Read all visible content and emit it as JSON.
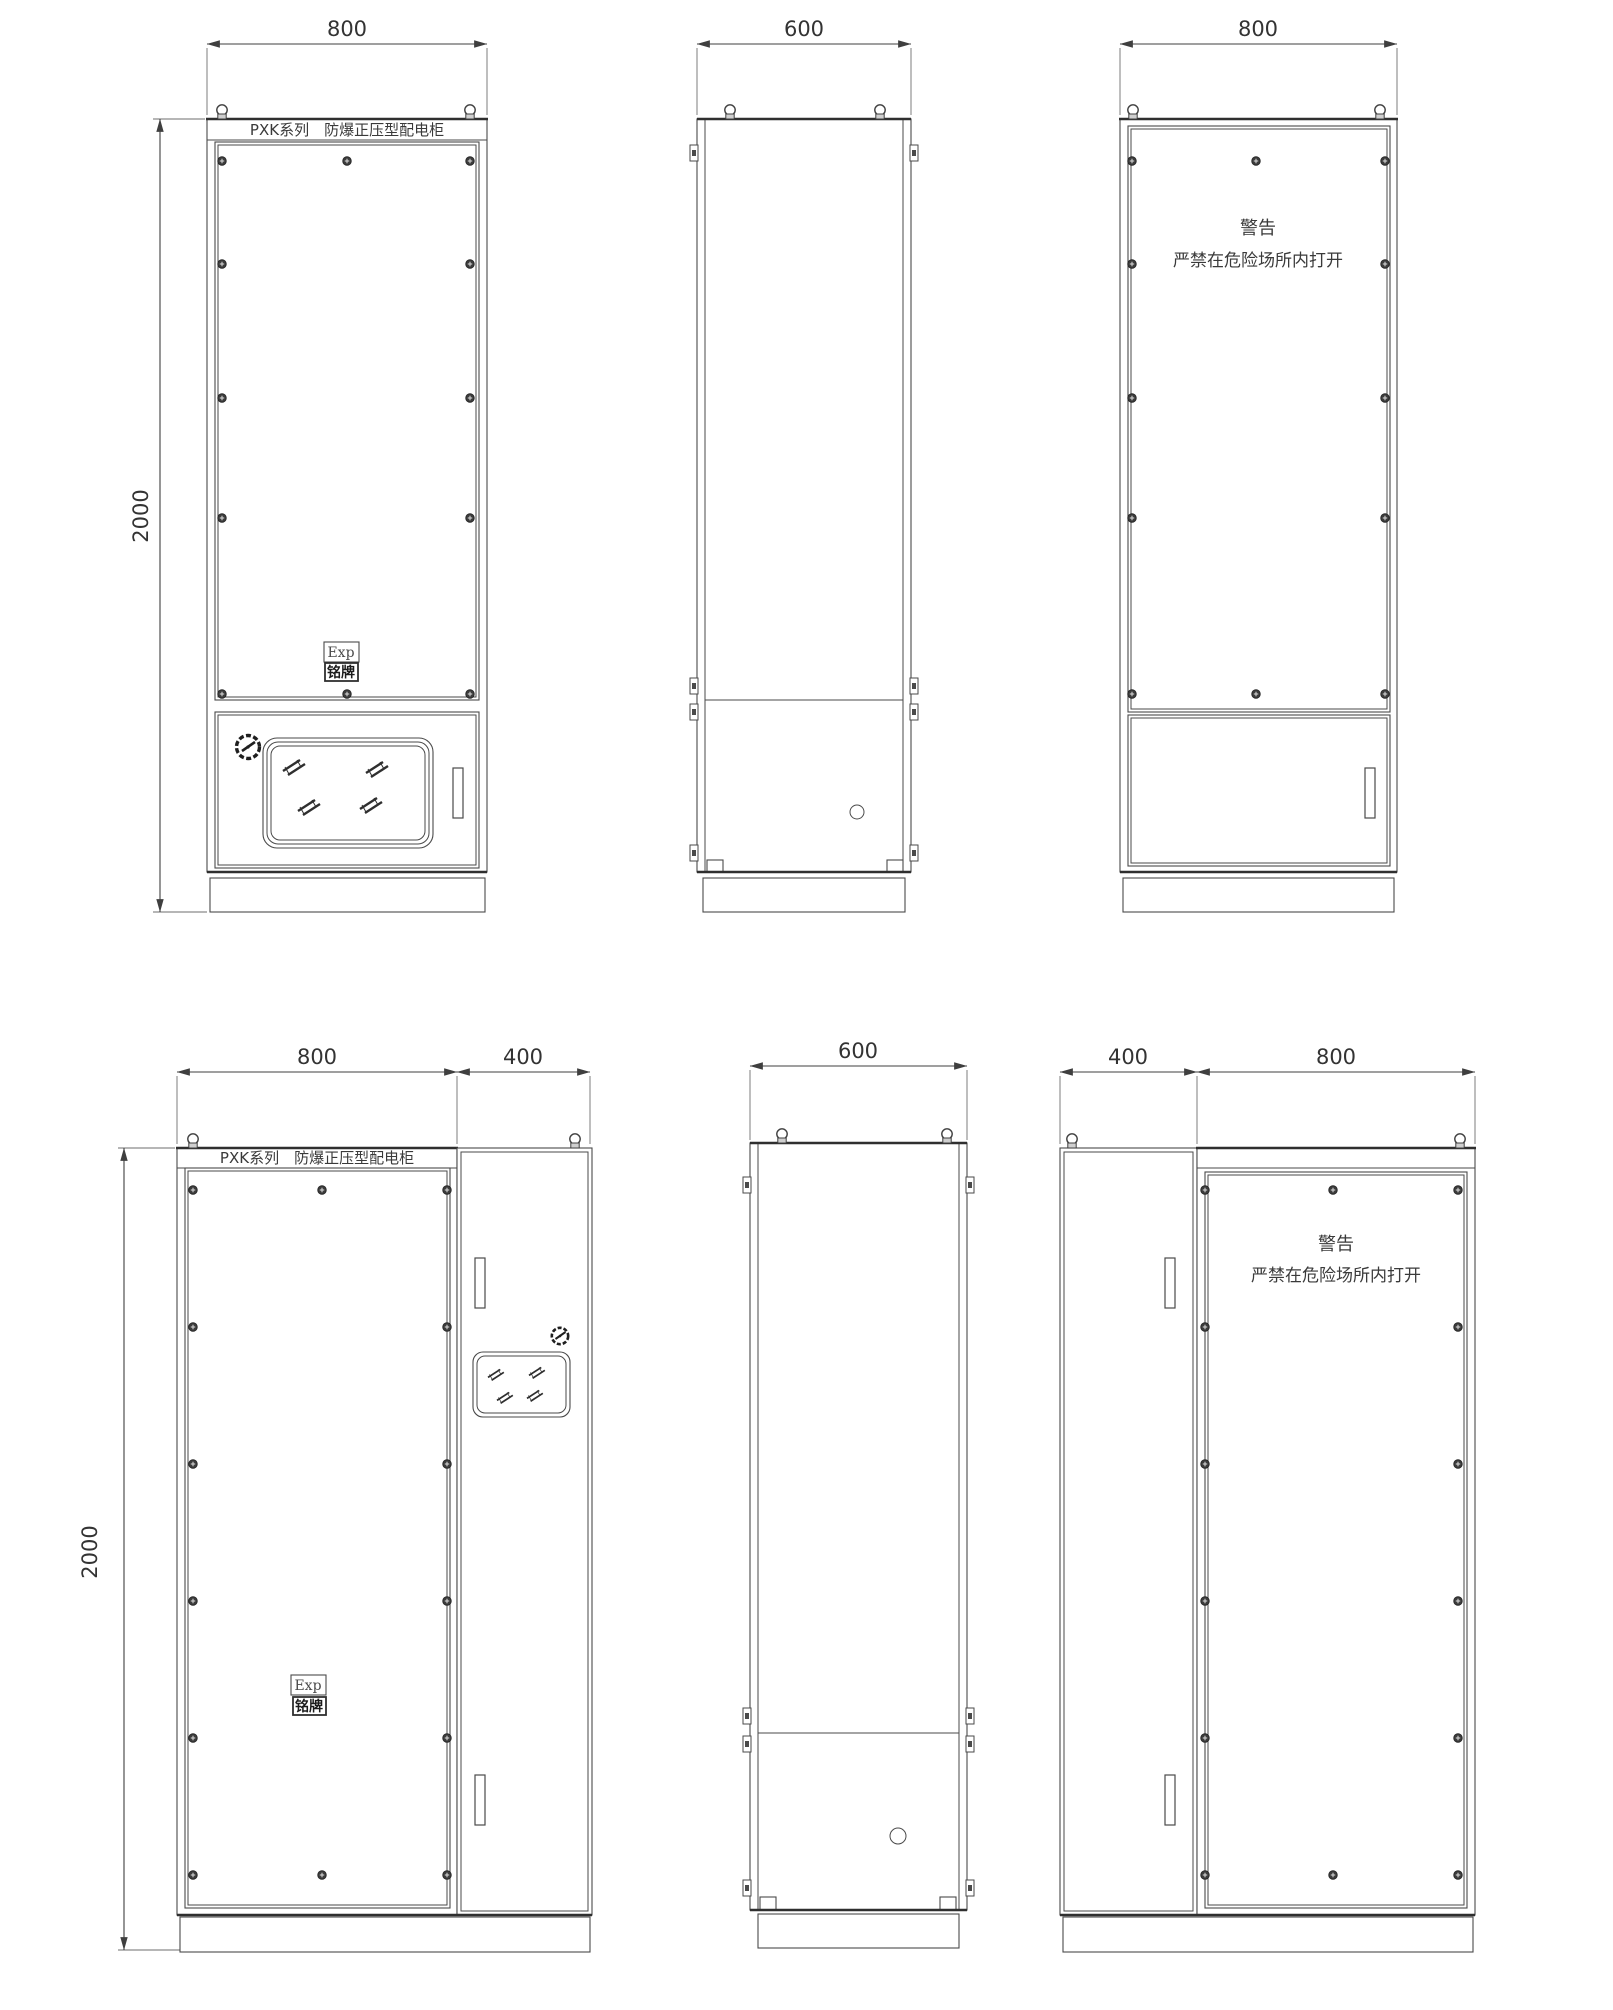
{
  "labels": {
    "product_header": "PXK系列　防爆正压型配电柜",
    "warning_title": "警告",
    "warning_body": "严禁在危险场所内打开",
    "nameplate_exp": "Exp",
    "nameplate_plate": "铭牌"
  },
  "dimensions": {
    "width_main": "800",
    "depth": "600",
    "width_duct": "400",
    "height": "2000"
  },
  "colors": {
    "line": "#4a4a4a",
    "line_strong": "#2f2f2f",
    "text": "#3a3a3a",
    "background": "#ffffff"
  }
}
